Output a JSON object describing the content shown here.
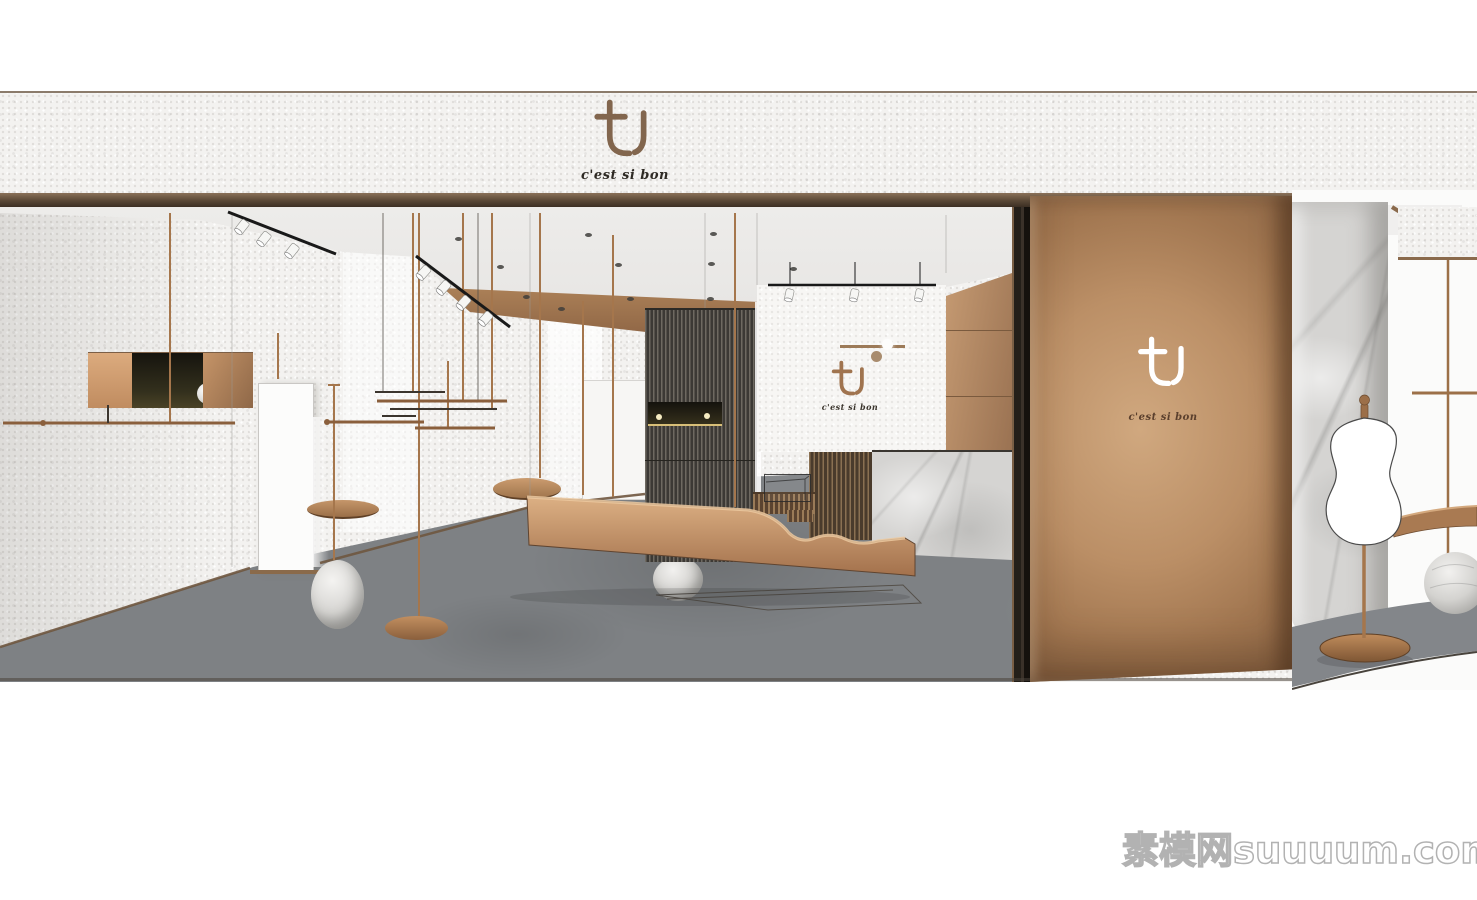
{
  "brand": {
    "logo_text": "tU",
    "tagline": "c'est si bon"
  },
  "signs": {
    "fascia": {
      "logo": "tU",
      "tagline": "c'est si bon"
    },
    "interior_wall": {
      "logo": "tU",
      "tagline": "c'est si bon"
    },
    "column": {
      "logo": "tU",
      "tagline": "c'est si bon"
    }
  },
  "watermark": {
    "text": "素模网suuuum.com"
  },
  "palette": {
    "copper": "#b5895c",
    "copper_light": "#d9ae80",
    "copper_dark": "#8a6246",
    "bronze_trim": "#6e5a46",
    "wall_white": "#f3f2f0",
    "floor_gray": "#7e8184",
    "marble_gray": "#d5d4d2",
    "slat_dark": "#3c3935",
    "track_black": "#1c1c1c",
    "mannequin_white": "#ffffff",
    "watermark_gray": "#9f9f9f"
  }
}
